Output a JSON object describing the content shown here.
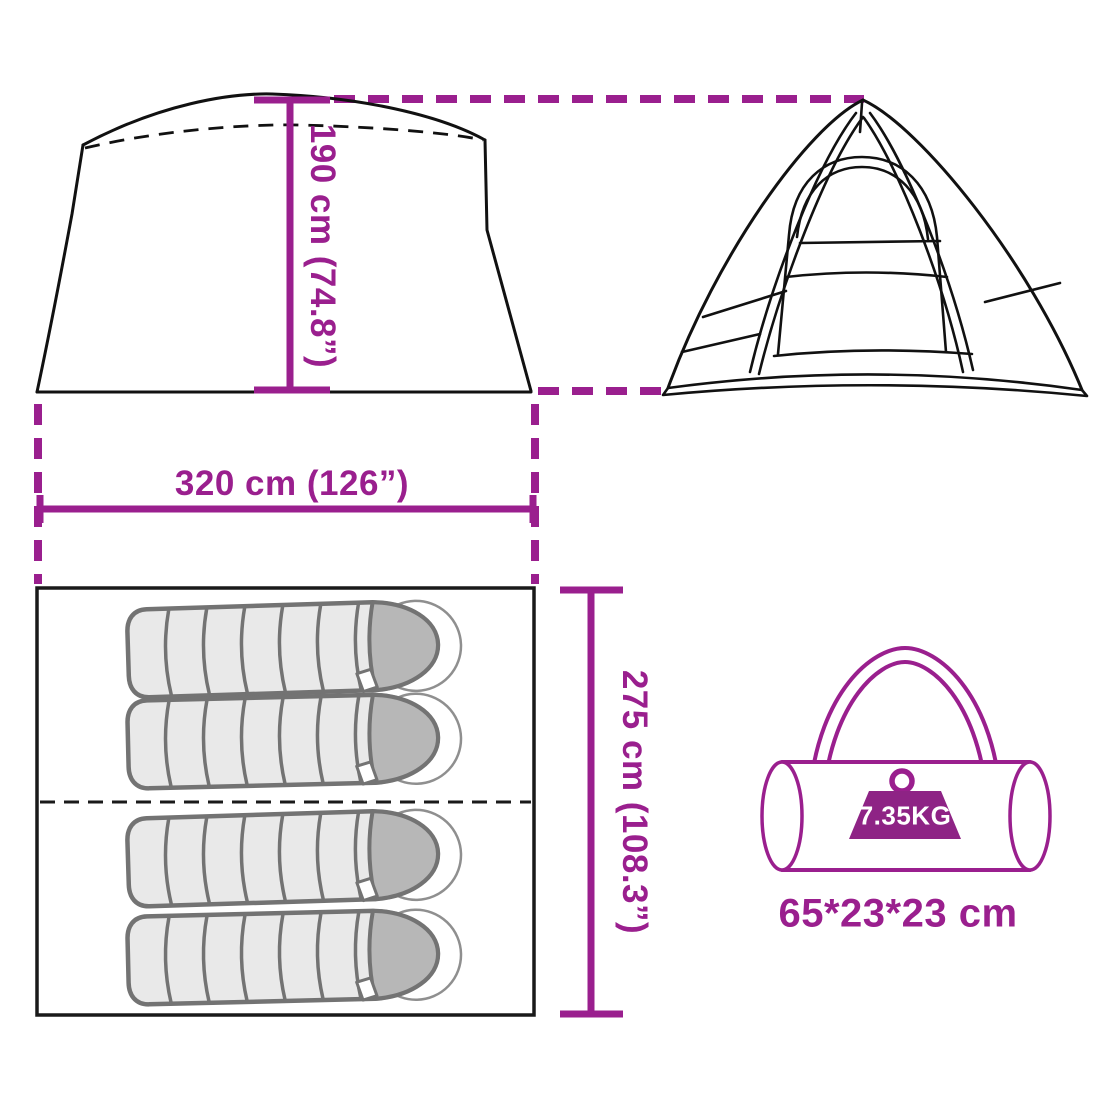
{
  "title": "Tent dimensions diagram",
  "colors": {
    "accent": "#9a1f8e",
    "badge": "#8e2385",
    "outline": "#111111",
    "plan_border": "#1a1a1a",
    "bag_fill": "#e9e9e9",
    "bag_outline": "#737373",
    "hood_fill": "#b7b7b7",
    "ghost": "#8f8f8f"
  },
  "dimensions": {
    "height": "190 cm (74.8”)",
    "width": "320 cm (126”)",
    "depth": "275 cm (108.3”)"
  },
  "packed": {
    "weight": "7.35KG",
    "size": "65*23*23 cm"
  },
  "views": {
    "side": "tent-side-view",
    "front": "tent-front-view",
    "floor": "floor-plan-top-view",
    "bag": "carry-bag"
  },
  "floor_plan": {
    "sleeping_bag_count": 4
  }
}
